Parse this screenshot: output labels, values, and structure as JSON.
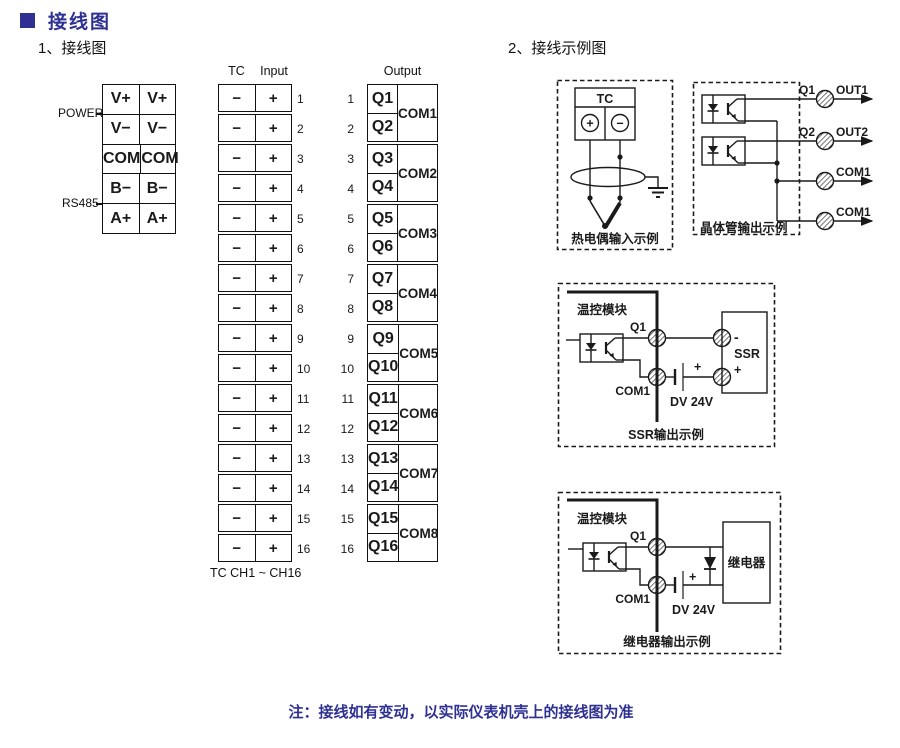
{
  "page": {
    "title": "接线图",
    "section1_title": "1、接线图",
    "section2_title": "2、接线示例图",
    "note": "注：接线如有变动，以实际仪表机壳上的接线图为准"
  },
  "colors": {
    "accent": "#2e3192",
    "line": "#1a1a1a"
  },
  "power_block": {
    "group_labels": [
      "POWER",
      "RS485"
    ],
    "rows": [
      [
        "V+",
        "V+"
      ],
      [
        "V−",
        "V−"
      ],
      [
        "COM",
        "COM"
      ],
      [
        "B−",
        "B−"
      ],
      [
        "A+",
        "A+"
      ]
    ]
  },
  "input_block": {
    "header_tc": "TC",
    "header_input": "Input",
    "minus": "−",
    "plus": "+",
    "channel_count": 16,
    "footer": "TC CH1 ~ CH16"
  },
  "output_block": {
    "header": "Output",
    "q_labels": [
      "Q1",
      "Q2",
      "Q3",
      "Q4",
      "Q5",
      "Q6",
      "Q7",
      "Q8",
      "Q9",
      "Q10",
      "Q11",
      "Q12",
      "Q13",
      "Q14",
      "Q15",
      "Q16"
    ],
    "com_labels": [
      "COM1",
      "COM2",
      "COM3",
      "COM4",
      "COM5",
      "COM6",
      "COM7",
      "COM8"
    ]
  },
  "examples": {
    "thermocouple": {
      "header": "TC",
      "plus": "+",
      "minus": "−",
      "caption": "热电偶输入示例"
    },
    "transistor": {
      "caption": "晶体管输出示例",
      "q1": "Q1",
      "out1": "OUT1",
      "q2": "Q2",
      "out2": "OUT2",
      "com1a": "COM1",
      "com1b": "COM1"
    },
    "ssr": {
      "module": "温控模块",
      "q": "Q1",
      "com": "COM1",
      "battery_plus": "+",
      "battery": "DV 24V",
      "device": "SSR",
      "term_minus": "-",
      "term_plus": "+",
      "caption": "SSR输出示例"
    },
    "relay": {
      "module": "温控模块",
      "q": "Q1",
      "com": "COM1",
      "battery_plus": "+",
      "battery": "DV 24V",
      "device": "继电器",
      "caption": "继电器输出示例"
    }
  }
}
